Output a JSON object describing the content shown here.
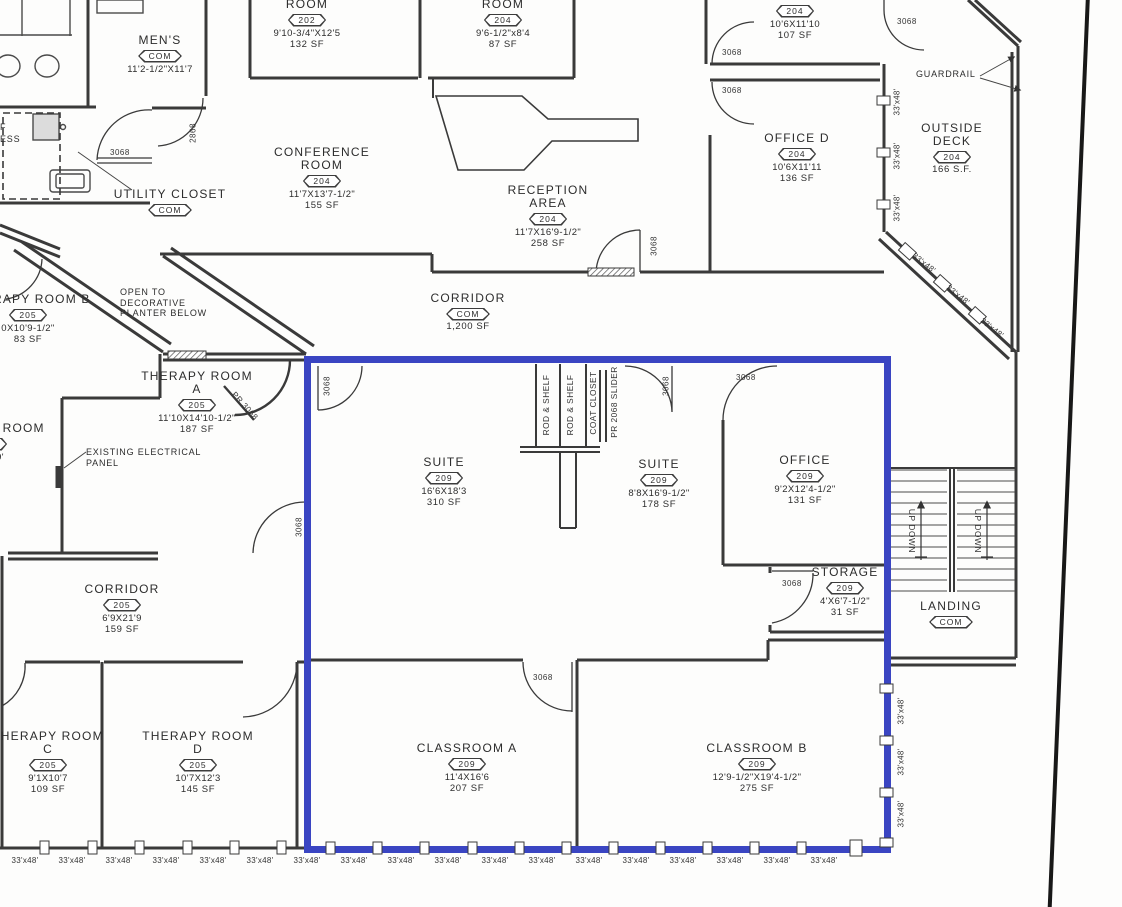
{
  "highlight_color": "#3a45c2",
  "window_size_label": "33'x48'",
  "annotations": {
    "guardrail": "GUARDRAIL",
    "open_planter_line1": "OPEN TO",
    "open_planter_line2": "DECORATIVE",
    "open_planter_line3": "PLANTER BELOW",
    "electrical_line1": "EXISTING ELECTRICAL",
    "electrical_line2": "PANEL",
    "stairs_direction": "UP DOWN",
    "edge_fragment_1": "F",
    "edge_fragment_2": "ESS"
  },
  "doors": {
    "single": "3068",
    "narrow": "2868",
    "pair": "PR 3068",
    "slider": "PR 2068 SLIDER",
    "rod_shelf": "ROD & SHELF",
    "coat_closet": "COAT CLOSET"
  },
  "rooms": [
    {
      "name": "MEN'S",
      "tag": "COM",
      "dims": "11'2-1/2\"X11'7",
      "area": ""
    },
    {
      "name": "ROOM",
      "tag": "202",
      "dims": "9'10-3/4\"X12'5",
      "area": "132 SF"
    },
    {
      "name": "ROOM",
      "tag": "204",
      "dims": "9'6-1/2\"x8'4",
      "area": "87 SF"
    },
    {
      "name": "",
      "tag": "204",
      "dims": "10'6X11'10",
      "area": "107 SF"
    },
    {
      "name": "CONFERENCE ROOM",
      "tag": "204",
      "dims": "11'7X13'7-1/2\"",
      "area": "155 SF"
    },
    {
      "name": "RECEPTION AREA",
      "tag": "204",
      "dims": "11'7X16'9-1/2\"",
      "area": "258 SF"
    },
    {
      "name": "OFFICE D",
      "tag": "204",
      "dims": "10'6X11'11",
      "area": "136 SF"
    },
    {
      "name": "OUTSIDE DECK",
      "tag": "204",
      "dims": "",
      "area": "166 S.F."
    },
    {
      "name": "UTILITY CLOSET",
      "tag": "COM",
      "dims": "",
      "area": ""
    },
    {
      "name": "CORRIDOR",
      "tag": "COM",
      "dims": "",
      "area": "1,200 SF"
    },
    {
      "name": "THERAPY ROOM B",
      "tag": "205",
      "dims": "0X10'9-1/2\"",
      "area": "83 SF"
    },
    {
      "name": "THERAPY ROOM A",
      "tag": "205",
      "dims": "11'10X14'10-1/2\"",
      "area": "187 SF"
    },
    {
      "name": "STORAGE ROOM",
      "tag": "205",
      "dims": "7'2\"X9'",
      "area": "SF"
    },
    {
      "name": "CORRIDOR",
      "tag": "205",
      "dims": "6'9X21'9",
      "area": "159 SF"
    },
    {
      "name": "SUITE",
      "tag": "209",
      "dims": "16'6X18'3",
      "area": "310 SF"
    },
    {
      "name": "SUITE",
      "tag": "209",
      "dims": "8'8X16'9-1/2\"",
      "area": "178 SF"
    },
    {
      "name": "OFFICE",
      "tag": "209",
      "dims": "9'2X12'4-1/2\"",
      "area": "131 SF"
    },
    {
      "name": "STORAGE",
      "tag": "209",
      "dims": "4'X6'7-1/2\"",
      "area": "31 SF"
    },
    {
      "name": "LANDING",
      "tag": "COM",
      "dims": "",
      "area": ""
    },
    {
      "name": "THERAPY ROOM C",
      "tag": "205",
      "dims": "9'1X10'7",
      "area": "109 SF"
    },
    {
      "name": "THERAPY ROOM D",
      "tag": "205",
      "dims": "10'7X12'3",
      "area": "145 SF"
    },
    {
      "name": "CLASSROOM A",
      "tag": "209",
      "dims": "11'4X16'6",
      "area": "207 SF"
    },
    {
      "name": "CLASSROOM B",
      "tag": "209",
      "dims": "12'9-1/2\"X19'4-1/2\"",
      "area": "275 SF"
    }
  ]
}
